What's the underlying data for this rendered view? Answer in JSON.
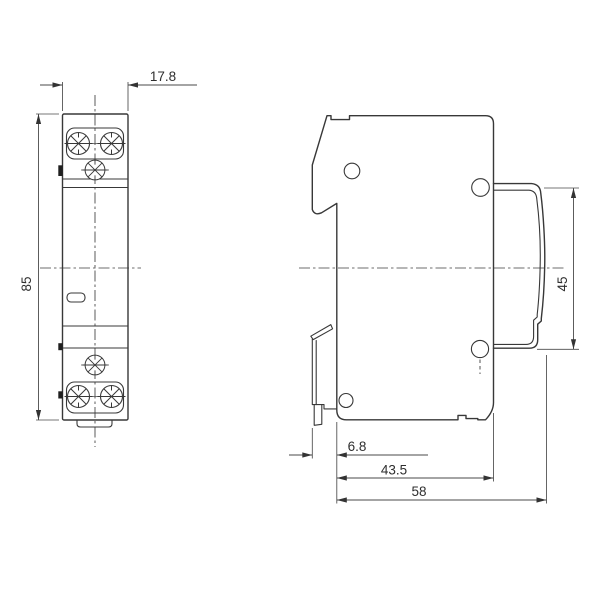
{
  "drawing": {
    "type": "technical-dimension-drawing",
    "views": {
      "front": "front-view-of-din-module",
      "side": "side-view-of-din-module"
    },
    "colors": {
      "line": "#383838",
      "dimension_line": "#4a4a4a",
      "text": "#2e2e2e",
      "background": "#ffffff"
    }
  },
  "dimensions": {
    "front_width": "17.8",
    "front_height": "85",
    "rail_recess_height": "45",
    "clip_offset": "6.8",
    "body_depth": "43.5",
    "total_depth": "58"
  }
}
